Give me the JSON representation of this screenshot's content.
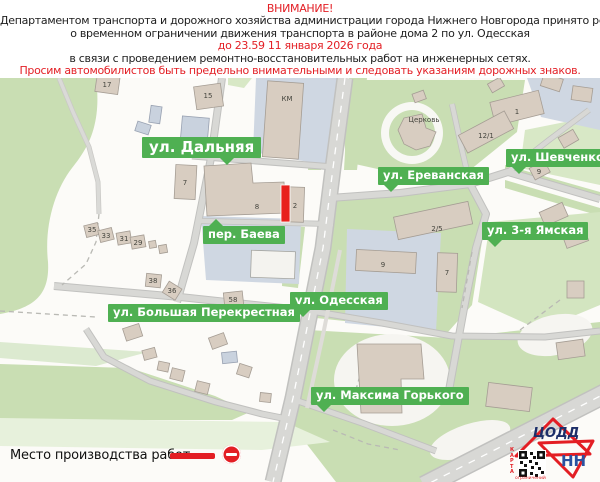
{
  "colors": {
    "alert_red": "#e31e24",
    "label_green": "#4fb052",
    "logo_navy": "#1d2f69",
    "logo_blue": "#2b52a0"
  },
  "header": {
    "line1": "ВНИМАНИЕ!",
    "line2": "Департаментом транспорта и дорожного хозяйства администрации города Нижнего Новгорода принято решение",
    "line3": "о временном ограничении движения транспорта в районе дома 2 по ул. Одесская",
    "line4": "до 23.59 11 января 2026 года",
    "line5": "в связи с проведением ремонтно-восстановительных работ на инженерных сетях.",
    "line6": "Просим автомобилистов быть предельно внимательными и следовать указаниям дорожных знаков."
  },
  "map": {
    "street_labels": {
      "dalnyaya": "ул. Дальняя",
      "erevanskaya": "ул. Ереванская",
      "shevchenko": "ул. Шевченко",
      "yamskaya": "ул. 3-я Ямская",
      "baeva": "пер. Баева",
      "odesskaya": "ул. Одесская",
      "perekrestnaya": "ул. Большая Перекрестная",
      "gorkogo": "ул. Максима Горького"
    },
    "building_labels": {
      "b17": "17",
      "b15": "15",
      "km": "КМ",
      "church": "Церковь",
      "b1": "1",
      "b12_1": "12/1",
      "b9r": "9",
      "b7l": "7",
      "b8": "8",
      "b2": "2",
      "b2_5": "2/5",
      "b9c": "9",
      "b7r": "7",
      "b35": "35",
      "b33": "33",
      "b31": "31",
      "b29": "29",
      "b38": "38",
      "b36": "36",
      "b58": "58"
    }
  },
  "legend": {
    "label": "Место производства работ -"
  },
  "logo": {
    "line1": "ЦОДД",
    "line2": "НН",
    "qr_side": "КАРТА",
    "qr_bottom": "ограничений"
  }
}
